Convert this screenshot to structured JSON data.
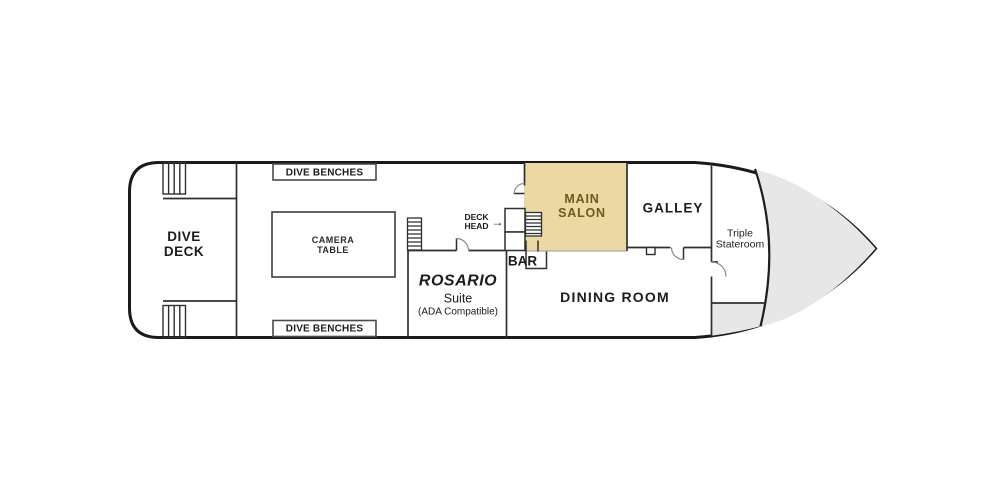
{
  "plan": {
    "colors": {
      "main_salon_fill": "#ecd8a2",
      "main_salon_text": "#6d5a1c",
      "bow_fill": "#e7e7e7"
    },
    "labels": {
      "dive_deck": {
        "lines": [
          "DIVE",
          "DECK"
        ]
      },
      "dive_benches_top": {
        "text": "DIVE BENCHES"
      },
      "dive_benches_bottom": {
        "text": "DIVE BENCHES"
      },
      "camera_table": {
        "lines": [
          "CAMERA",
          "TABLE"
        ]
      },
      "deck_head": {
        "lines": [
          "DECK",
          "HEAD"
        ],
        "arrow": "→"
      },
      "bar": {
        "text": "BAR"
      },
      "rosario_suite": {
        "name": "ROSARIO",
        "type": "Suite",
        "note": "(ADA Compatible)"
      },
      "main_salon": {
        "lines": [
          "MAIN",
          "SALON"
        ]
      },
      "galley": {
        "text": "GALLEY"
      },
      "dining_room": {
        "text": "DINING ROOM"
      },
      "triple_stateroom": {
        "lines": [
          "Triple",
          "Stateroom"
        ]
      }
    }
  }
}
